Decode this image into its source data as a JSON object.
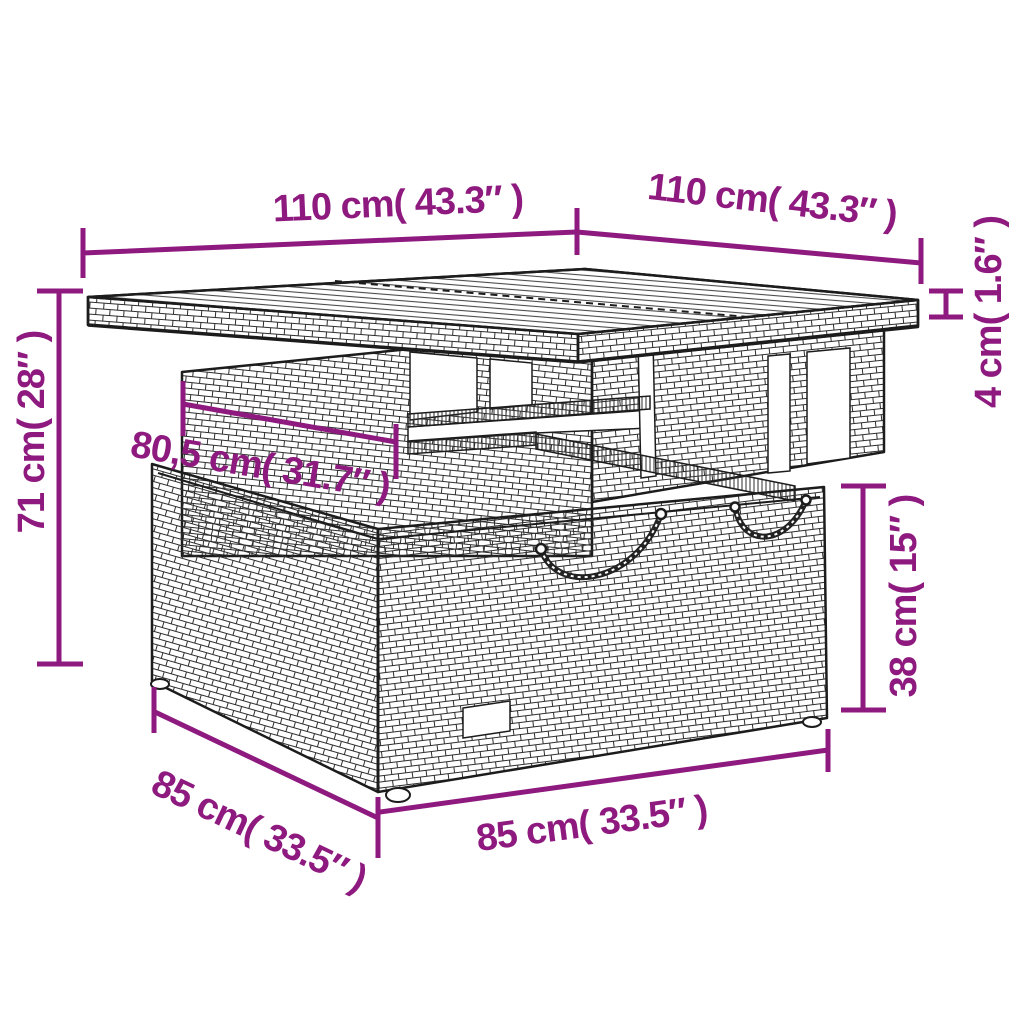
{
  "annotations": {
    "top_width": "110 cm( 43.3″ )",
    "top_depth": "110 cm( 43.3″ )",
    "top_thickness": "4 cm( 1.6″ )",
    "total_height": "71 cm( 28″ )",
    "inner_width": "80,5 cm( 31.7″ )",
    "base_height": "38 cm( 15″ )",
    "base_width": "85 cm( 33.5″ )",
    "base_depth": "85 cm( 33.5″ )"
  },
  "colors": {
    "annotation": "#8e1a7f",
    "drawing_line": "#1c1c1c",
    "background": "#ffffff"
  }
}
